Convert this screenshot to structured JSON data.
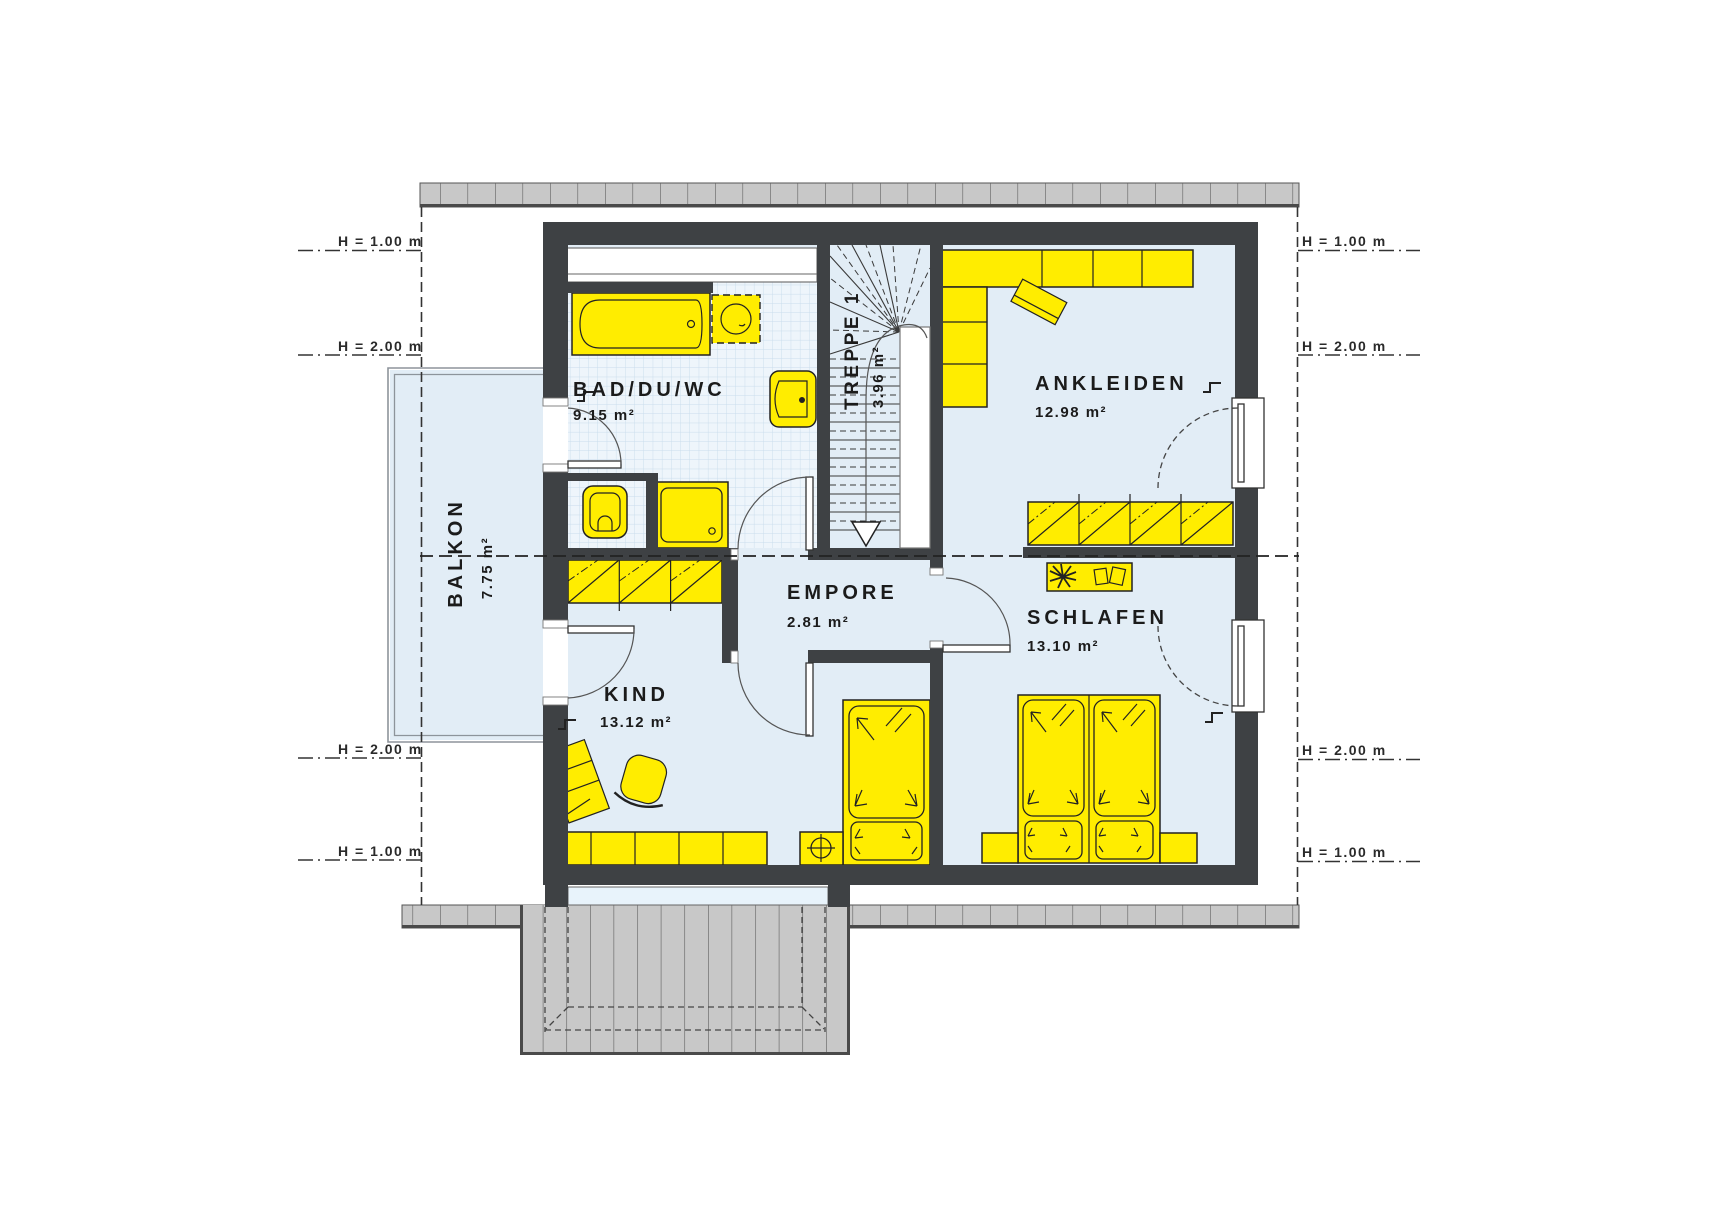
{
  "plan": {
    "rooms": {
      "bad": {
        "name": "BAD/DU/WC",
        "area": "9.15 m²"
      },
      "treppe": {
        "name": "TREPPE 1",
        "area": "3.96 m²"
      },
      "ankleiden": {
        "name": "ANKLEIDEN",
        "area": "12.98 m²"
      },
      "empore": {
        "name": "EMPORE",
        "area": "2.81 m²"
      },
      "kind": {
        "name": "KIND",
        "area": "13.12 m²"
      },
      "schlafen": {
        "name": "SCHLAFEN",
        "area": "13.10 m²"
      },
      "balkon": {
        "name": "BALKON",
        "area": "7.75 m²"
      }
    },
    "height_markers": {
      "h1": "H = 1.00 m",
      "h2": "H = 2.00 m"
    },
    "colors": {
      "wall": "#3e4144",
      "floor": "#e2edf6",
      "tile_floor": "#eef5fb",
      "furniture": "#ffed00",
      "roof_band": "#c8c8c8",
      "outline": "#222222"
    }
  }
}
